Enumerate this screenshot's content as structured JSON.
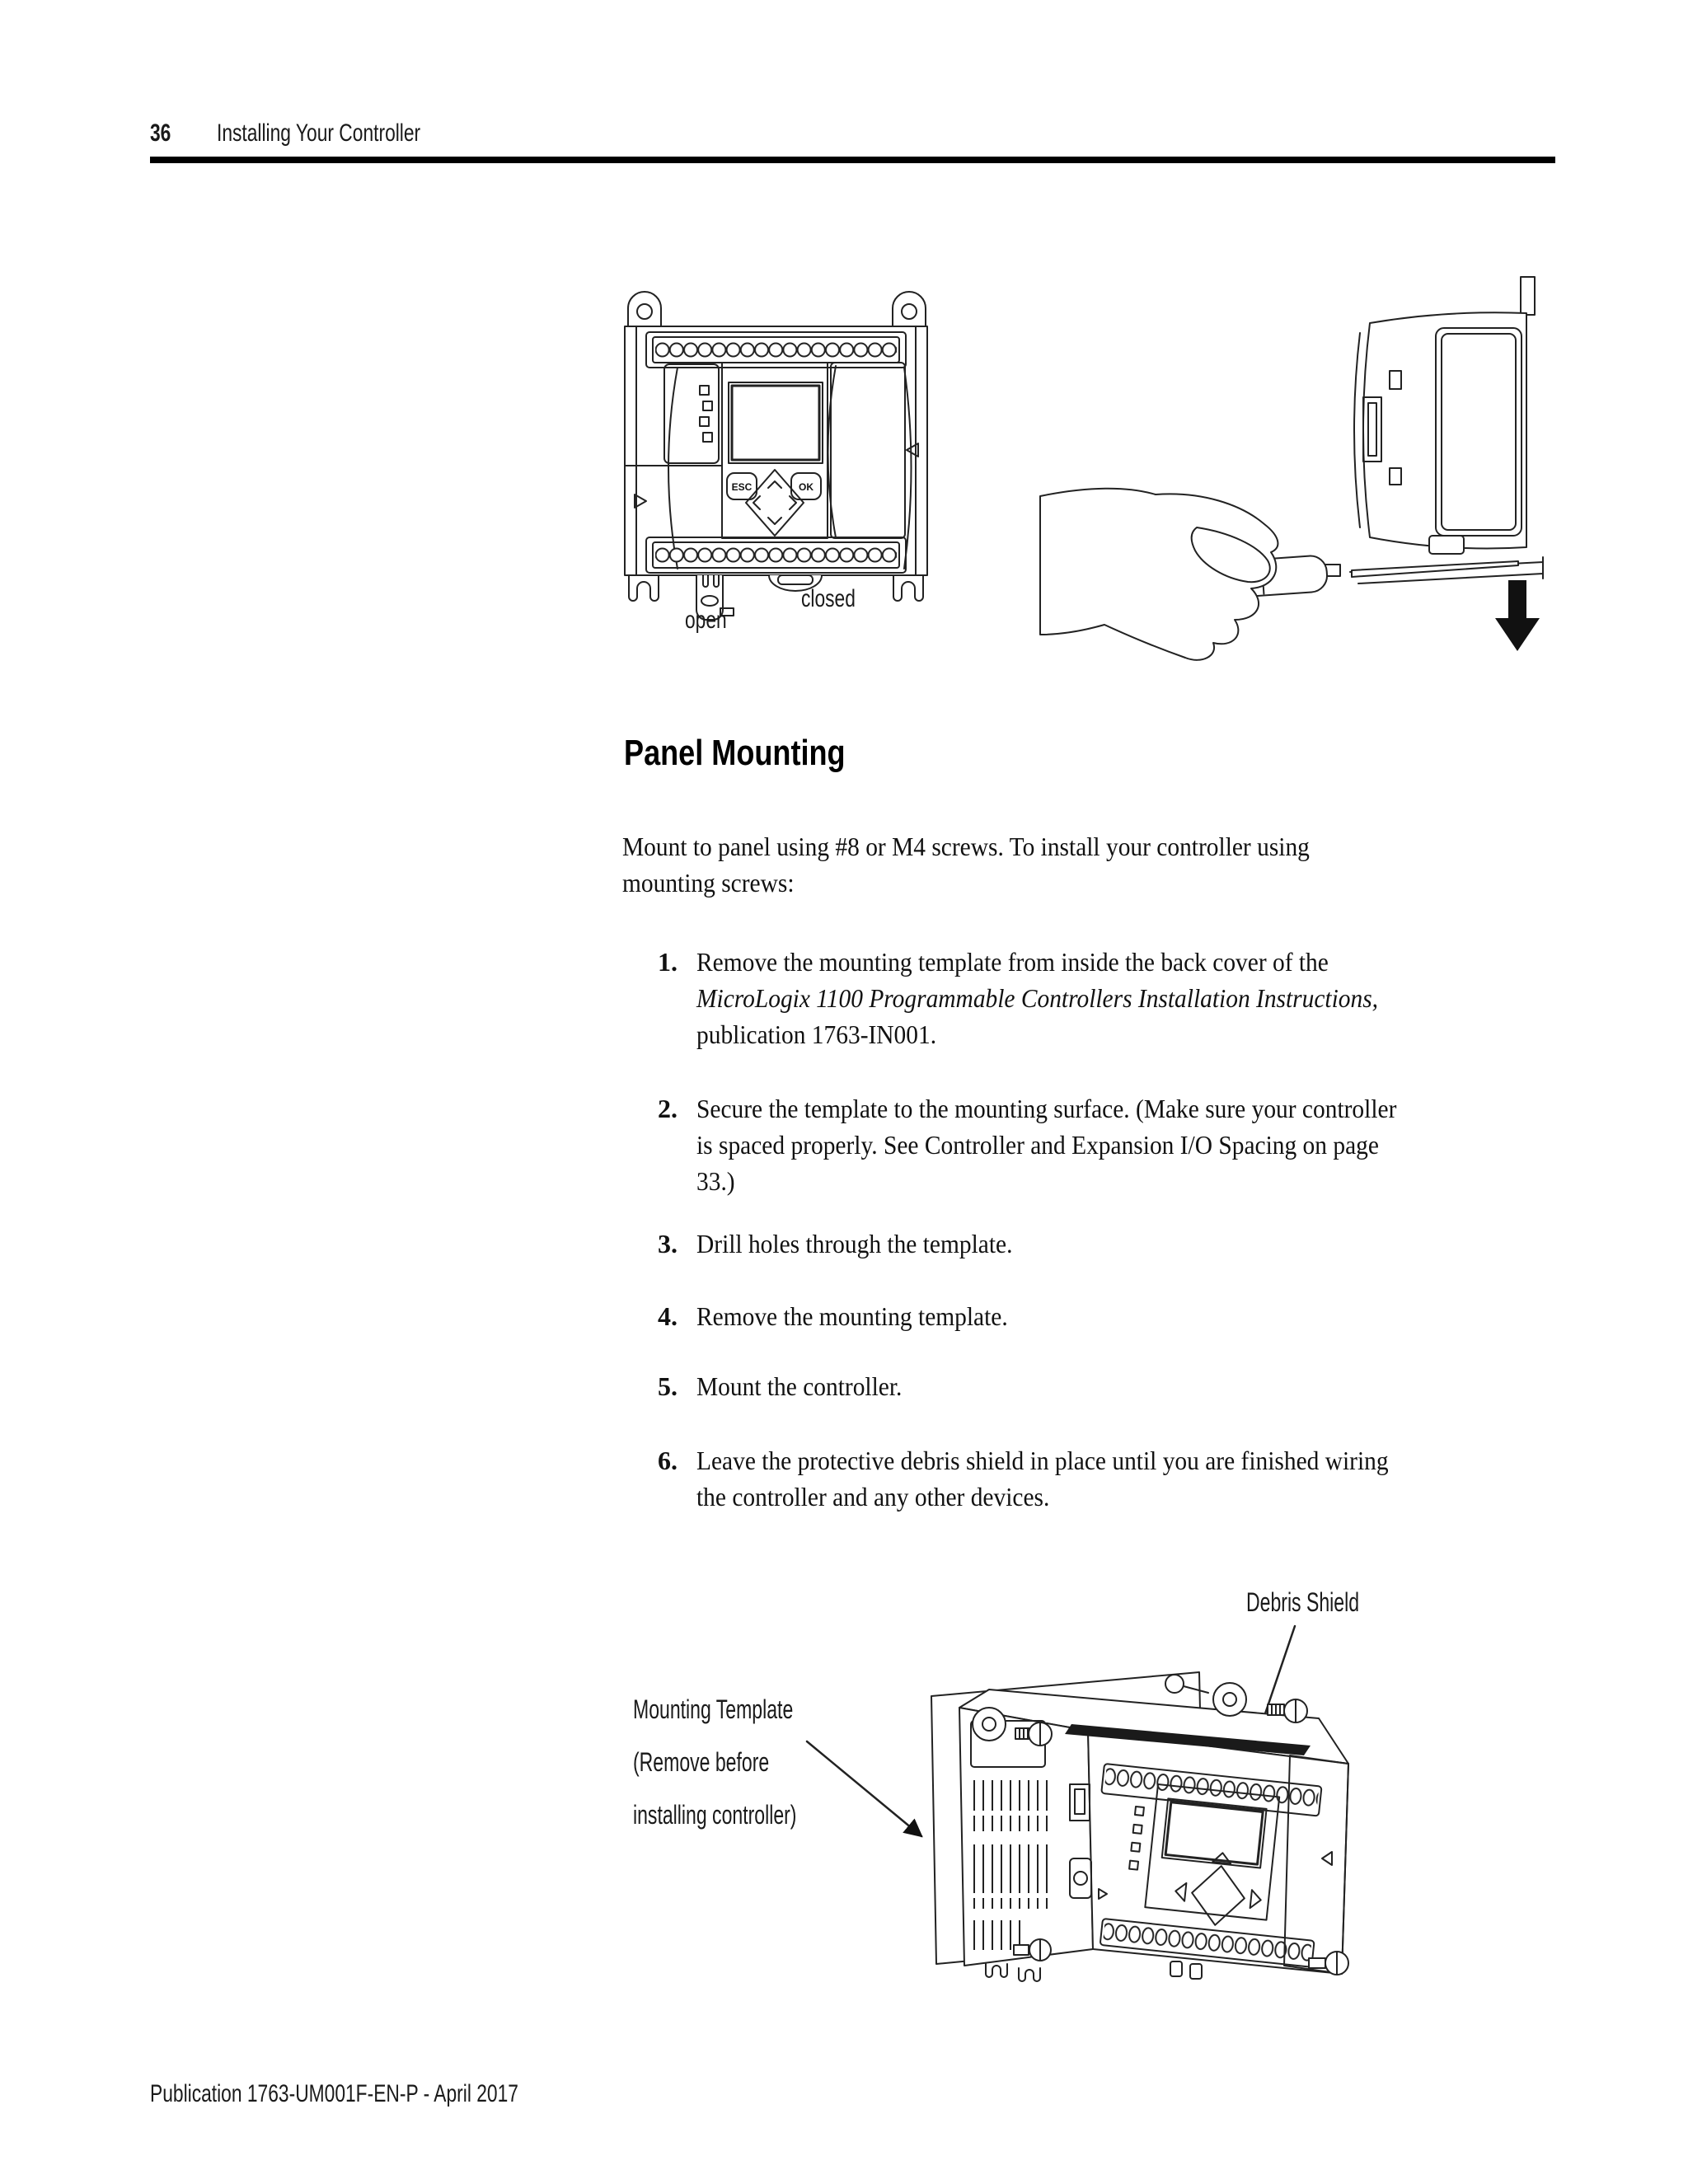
{
  "page": {
    "number": "36",
    "header_title": "Installing Your Controller",
    "footer": "Publication 1763-UM001F-EN-P - April 2017"
  },
  "section": {
    "title": "Panel Mounting",
    "intro_lines": [
      "Mount to panel using #8 or M4 screws. To install your controller using",
      "mounting screws:"
    ],
    "steps": [
      {
        "num": "1.",
        "lines": [
          {
            "text": "Remove the mounting template from inside the back cover of the"
          },
          {
            "text": "MicroLogix 1100 Programmable Controllers Installation Instructions,",
            "italic": true
          },
          {
            "text": "publication 1763-IN001."
          }
        ]
      },
      {
        "num": "2.",
        "lines": [
          {
            "text": "Secure the template to the mounting surface. (Make sure your controller"
          },
          {
            "text": "is spaced properly. See Controller and Expansion I/O Spacing on page"
          },
          {
            "text": "33.)"
          }
        ]
      },
      {
        "num": "3.",
        "lines": [
          {
            "text": "Drill holes through the template."
          }
        ]
      },
      {
        "num": "4.",
        "lines": [
          {
            "text": "Remove the mounting template."
          }
        ]
      },
      {
        "num": "5.",
        "lines": [
          {
            "text": "Mount the controller."
          }
        ]
      },
      {
        "num": "6.",
        "lines": [
          {
            "text": "Leave the protective debris shield in place until you are finished wiring"
          },
          {
            "text": "the controller and any other devices."
          }
        ]
      }
    ]
  },
  "figure_din": {
    "open_label": "open",
    "closed_label": "closed",
    "esc_label": "ESC",
    "ok_label": "OK"
  },
  "figure_panel": {
    "debris_shield_label": "Debris Shield",
    "template_label_lines": [
      "Mounting Template",
      "(Remove before",
      "installing controller)"
    ]
  },
  "colors": {
    "text": "#111111",
    "line_art": "#222222",
    "rule": "#000000"
  }
}
